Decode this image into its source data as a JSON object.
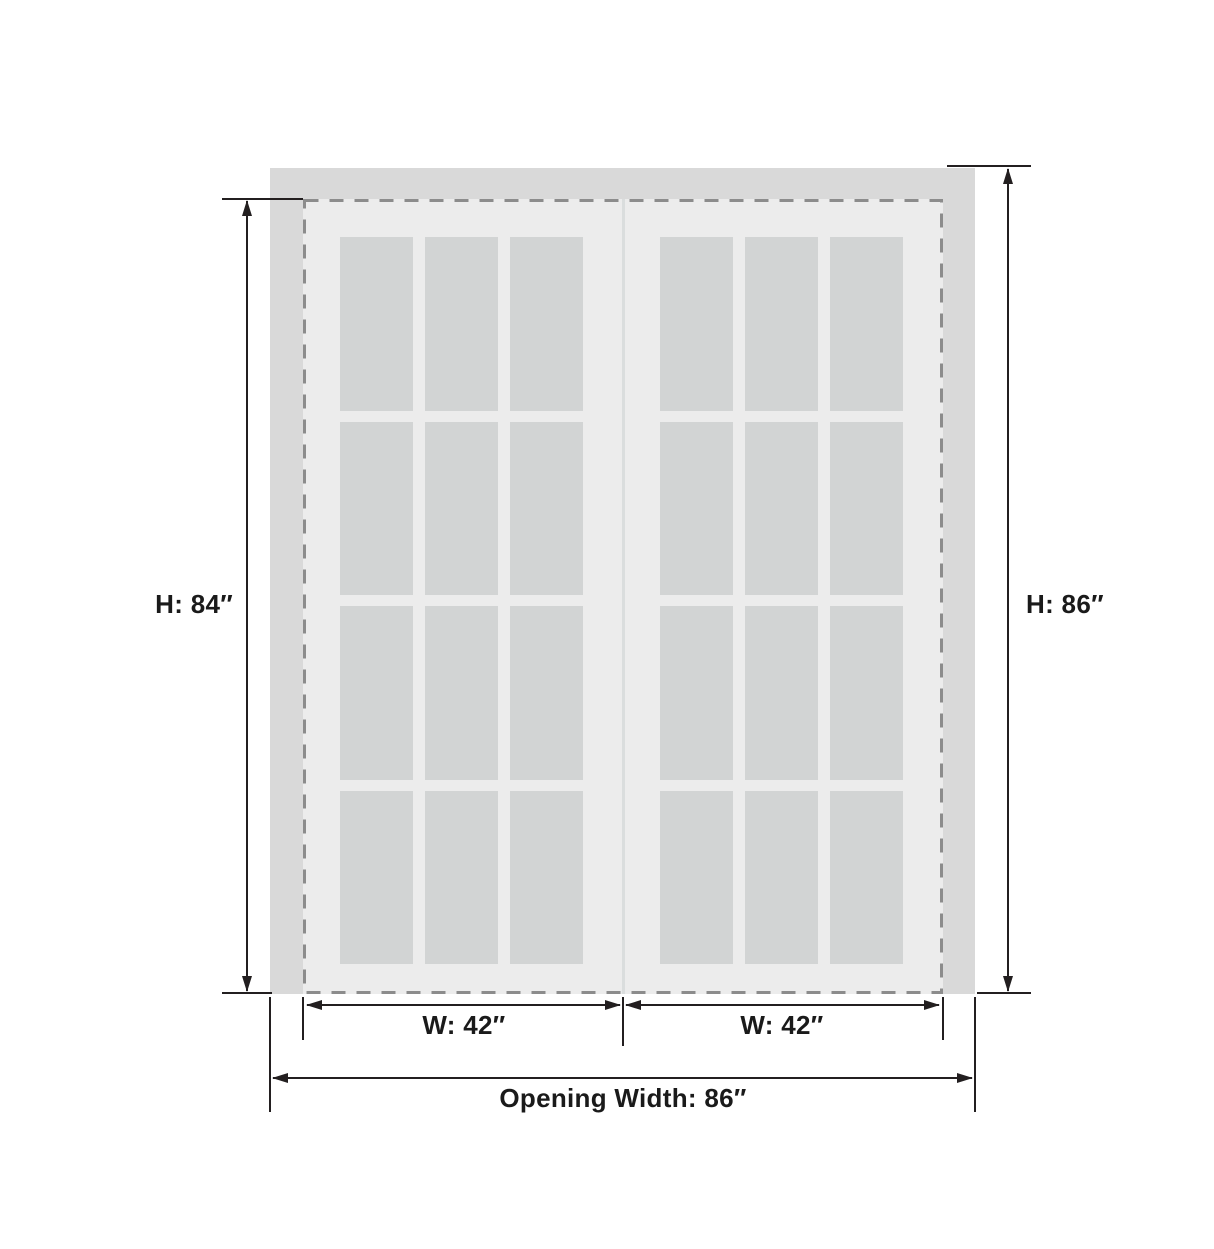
{
  "doors": {
    "count": 2,
    "grid_cols": 3,
    "grid_rows": 4
  },
  "labels": {
    "door_height": "H: 84″",
    "opening_height": "H: 86″",
    "door_width_left": "W: 42″",
    "door_width_right": "W: 42″",
    "opening_width": "Opening Width: 86″"
  },
  "colors": {
    "background": "#ffffff",
    "frame": "#d9d9d9",
    "slab": "#ececec",
    "pane": "#d2d4d4",
    "dash": "#8c8c8c",
    "line": "#231f20",
    "text": "#1a1a1a",
    "divider": "#dadddd"
  }
}
